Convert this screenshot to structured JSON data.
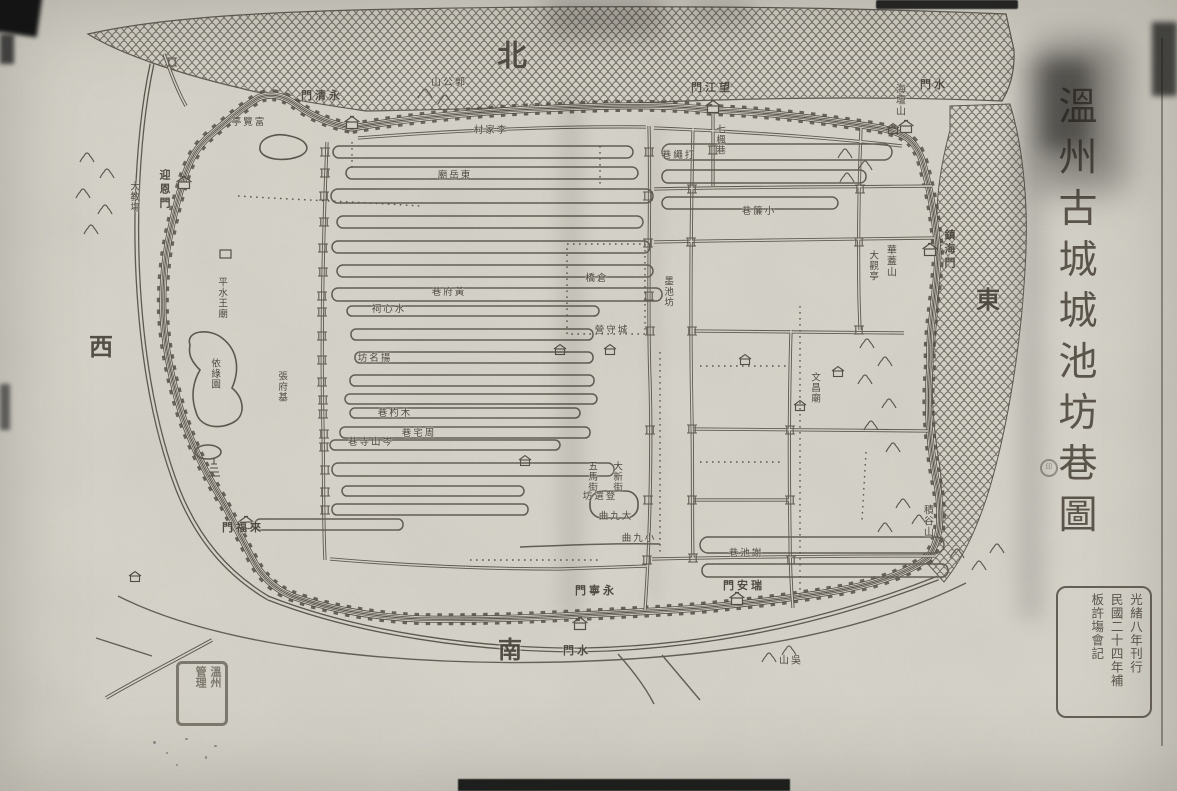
{
  "page": {
    "kind": "historical woodblock map, scanned print"
  },
  "title": {
    "text": "溫州古城城池坊巷圖"
  },
  "colophon": {
    "columns": [
      "光緒八年刊行",
      "民國二十四年補",
      "板許塲會記"
    ]
  },
  "collection_seal": {
    "columns": [
      "溫州",
      "管理"
    ]
  },
  "stamp_dot": {
    "text": "印"
  },
  "colors": {
    "paper": "#d5d2c8",
    "ink": "#555046",
    "water_line": "#6b665b",
    "label_ink": "#46413a"
  },
  "labels": [
    {
      "t": "北",
      "x": 512,
      "y": 57,
      "o": "s",
      "k": "compass",
      "s": 30
    },
    {
      "t": "西",
      "x": 101,
      "y": 349,
      "o": "s",
      "k": "compass",
      "s": 24
    },
    {
      "t": "南",
      "x": 510,
      "y": 652,
      "o": "s",
      "k": "compass",
      "s": 24
    },
    {
      "t": "東",
      "x": 988,
      "y": 302,
      "o": "s",
      "k": "compass",
      "s": 24
    },
    {
      "t": "永清門",
      "x": 322,
      "y": 97,
      "o": "h",
      "k": "gate"
    },
    {
      "t": "望江門",
      "x": 712,
      "y": 89,
      "o": "h",
      "k": "gate"
    },
    {
      "t": "水門",
      "x": 934,
      "y": 86,
      "o": "h",
      "k": "gate"
    },
    {
      "t": "鎮海門",
      "x": 948,
      "y": 250,
      "o": "v",
      "k": "gate"
    },
    {
      "t": "迎恩門",
      "x": 163,
      "y": 190,
      "o": "v",
      "k": "gate"
    },
    {
      "t": "來福門",
      "x": 243,
      "y": 529,
      "o": "h",
      "k": "gate"
    },
    {
      "t": "永寧門",
      "x": 596,
      "y": 592,
      "o": "h",
      "k": "gate"
    },
    {
      "t": "瑞安門",
      "x": 744,
      "y": 587,
      "o": "h",
      "k": "gate"
    },
    {
      "t": "水門",
      "x": 577,
      "y": 652,
      "o": "h",
      "k": "gate"
    },
    {
      "t": "郭公山",
      "x": 449,
      "y": 84,
      "o": "h",
      "k": "hill"
    },
    {
      "t": "富覽亭",
      "x": 249,
      "y": 123,
      "o": "h",
      "k": "place"
    },
    {
      "t": "海壇山",
      "x": 898,
      "y": 100,
      "o": "v",
      "k": "hill"
    },
    {
      "t": "華蓋山",
      "x": 889,
      "y": 261,
      "o": "v",
      "k": "hill"
    },
    {
      "t": "大觀亭",
      "x": 872,
      "y": 266,
      "o": "v",
      "k": "place"
    },
    {
      "t": "積谷山",
      "x": 926,
      "y": 521,
      "o": "v",
      "k": "hill"
    },
    {
      "t": "吳山",
      "x": 791,
      "y": 662,
      "o": "h",
      "k": "hill"
    },
    {
      "t": "大教塲",
      "x": 133,
      "y": 197,
      "o": "v",
      "k": "place"
    },
    {
      "t": "李家村",
      "x": 491,
      "y": 131,
      "o": "h",
      "k": "place"
    },
    {
      "t": "依綠園",
      "x": 214,
      "y": 374,
      "o": "v",
      "k": "place"
    },
    {
      "t": "張府基",
      "x": 281,
      "y": 387,
      "o": "v",
      "k": "place"
    },
    {
      "t": "平水王廟",
      "x": 221,
      "y": 298,
      "o": "v",
      "k": "place"
    },
    {
      "t": "東岳廟",
      "x": 455,
      "y": 176,
      "o": "h",
      "k": "place"
    },
    {
      "t": "倉橋",
      "x": 597,
      "y": 279,
      "o": "h",
      "k": "street"
    },
    {
      "t": "城守營",
      "x": 612,
      "y": 331,
      "o": "h",
      "k": "place"
    },
    {
      "t": "墨池坊",
      "x": 667,
      "y": 292,
      "o": "v",
      "k": "street"
    },
    {
      "t": "打繩巷",
      "x": 679,
      "y": 156,
      "o": "h",
      "k": "street"
    },
    {
      "t": "七楓巷",
      "x": 719,
      "y": 140,
      "o": "v",
      "k": "street"
    },
    {
      "t": "小簾巷",
      "x": 759,
      "y": 212,
      "o": "h",
      "k": "street"
    },
    {
      "t": "文昌廟",
      "x": 814,
      "y": 388,
      "o": "v",
      "k": "place"
    },
    {
      "t": "謝池巷",
      "x": 746,
      "y": 554,
      "o": "h",
      "k": "street"
    },
    {
      "t": "小九曲",
      "x": 639,
      "y": 539,
      "o": "h",
      "k": "street"
    },
    {
      "t": "大九曲",
      "x": 616,
      "y": 517,
      "o": "h",
      "k": "street"
    },
    {
      "t": "登選坊",
      "x": 600,
      "y": 497,
      "o": "h",
      "k": "street"
    },
    {
      "t": "五馬街",
      "x": 591,
      "y": 477,
      "o": "v",
      "k": "street"
    },
    {
      "t": "大新街",
      "x": 616,
      "y": 477,
      "o": "v",
      "k": "street"
    },
    {
      "t": "岑山寺巷",
      "x": 371,
      "y": 443,
      "o": "h",
      "k": "street"
    },
    {
      "t": "周宅巷",
      "x": 419,
      "y": 434,
      "o": "h",
      "k": "street"
    },
    {
      "t": "木杓巷",
      "x": 395,
      "y": 414,
      "o": "h",
      "k": "street"
    },
    {
      "t": "揚名坊",
      "x": 375,
      "y": 359,
      "o": "h",
      "k": "street"
    },
    {
      "t": "黃府巷",
      "x": 449,
      "y": 293,
      "o": "h",
      "k": "street"
    },
    {
      "t": "水心祠",
      "x": 389,
      "y": 310,
      "o": "h",
      "k": "place"
    }
  ]
}
